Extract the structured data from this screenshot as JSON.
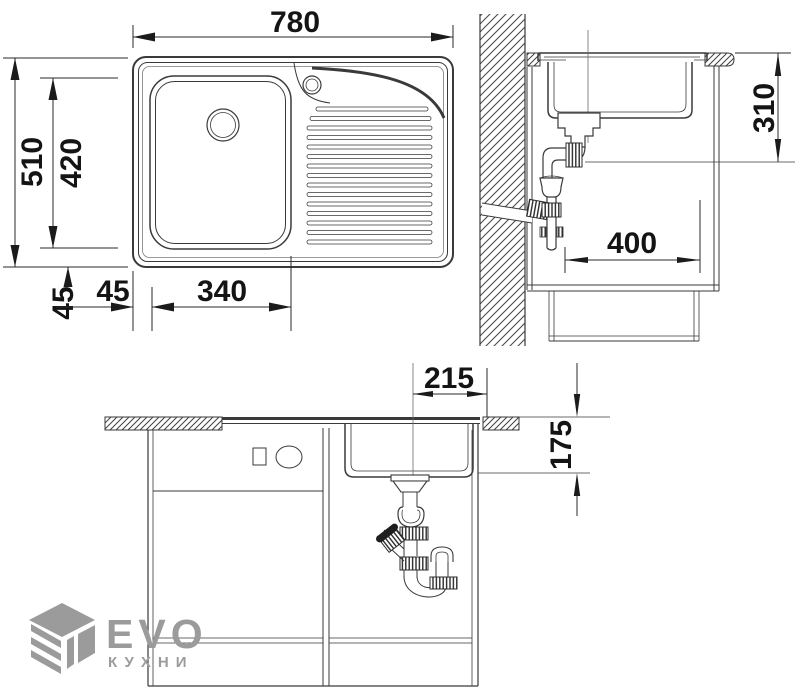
{
  "dimensions": {
    "plan": {
      "overall_width": "780",
      "overall_depth": "510",
      "bowl_depth": "420",
      "bowl_offset_bottom": "45",
      "bowl_offset_left": "45",
      "bowl_width": "340"
    },
    "side": {
      "height_under_worktop": "310",
      "cabinet_depth": "400"
    },
    "front": {
      "drain_center_offset": "215",
      "clearance_under_bowl": "175"
    }
  },
  "logo": {
    "brand": "EVO",
    "subtitle": "КУХНИ"
  },
  "colors": {
    "line": "#3a3a3a",
    "dim_text": "#141414",
    "logo": "#9b9b9b",
    "background": "#ffffff"
  }
}
